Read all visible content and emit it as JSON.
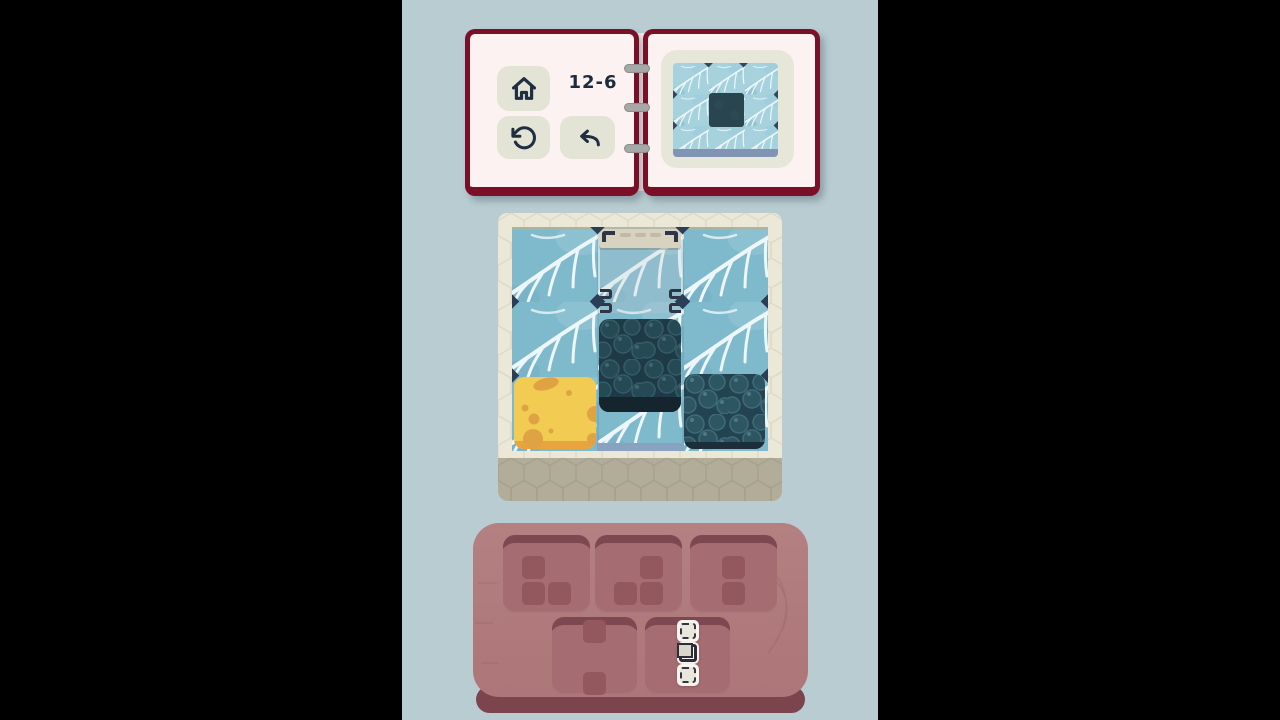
{
  "app": {
    "background_color": "#b8ccd2",
    "letterbox_color": "#000000"
  },
  "book": {
    "cover_color": "#7a1027",
    "page_color": "#fbf2f1",
    "binding_rings": 3,
    "left_page": {
      "level_label": "12-6",
      "buttons": [
        {
          "name": "home",
          "icon": "home-icon"
        },
        {
          "name": "restart",
          "icon": "restart-icon"
        },
        {
          "name": "undo",
          "icon": "undo-icon"
        }
      ]
    },
    "right_page": {
      "preview": {
        "description": "Target layout: 3x3 spiderweb-fabric board with one dark blueberry tile in the center",
        "grid": "3x3",
        "background_tile": "spiderweb",
        "center_tile": "blueberry"
      }
    }
  },
  "board": {
    "grid": "3x3",
    "tile_texture": "spiderweb",
    "frame_color": "#ebe8d7",
    "frame_front_color": "#b2ad98",
    "pieces": [
      {
        "type": "cheese",
        "row": 3,
        "col": 1,
        "color": "#f2cc52"
      },
      {
        "type": "blueberry",
        "row": 2,
        "col": 2,
        "state": "elevated",
        "color": "#22434f"
      },
      {
        "type": "blueberry",
        "row": 3,
        "col": 3,
        "color": "#22434f"
      }
    ],
    "placement_guide": {
      "column": 2,
      "clamp_top": true,
      "corner_clips": 4
    }
  },
  "tray": {
    "color": "#b07a7c",
    "slot_color": "#a56d71",
    "slots": [
      {
        "index": 0,
        "style": "silhouette",
        "shape": [
          [
            1,
            0
          ],
          [
            1,
            1
          ]
        ]
      },
      {
        "index": 1,
        "style": "silhouette",
        "shape": [
          [
            0,
            1
          ],
          [
            1,
            1
          ]
        ]
      },
      {
        "index": 2,
        "style": "silhouette",
        "shape": [
          [
            1
          ],
          [
            1
          ]
        ]
      },
      {
        "index": 3,
        "style": "silhouette",
        "shape": [
          [
            1
          ],
          [
            0
          ],
          [
            1
          ]
        ]
      },
      {
        "index": 4,
        "style": "ghost-outline",
        "shape": [
          [
            "dashed"
          ],
          [
            "solid"
          ],
          [
            "dashed"
          ]
        ]
      }
    ]
  },
  "colors": {
    "web_base": "#7fb9cc",
    "web_line": "#edf6f8",
    "notch_navy": "#2a3e55",
    "cheese": "#f2cc52",
    "cheese_hole": "#e0a344",
    "blueberry_base": "#22434f",
    "blueberry_front": "#16242e",
    "icon_navy": "#1f2e40",
    "tray_front": "#7c454e",
    "slot_lip": "#7d4850",
    "silhouette": "#92585e"
  }
}
